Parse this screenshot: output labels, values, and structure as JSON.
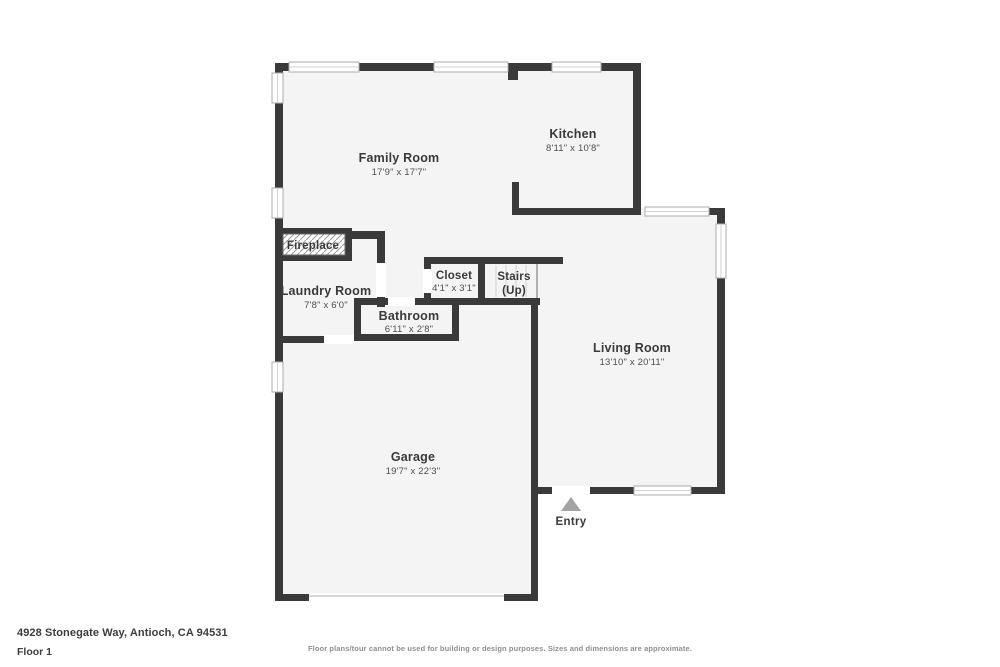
{
  "plan": {
    "wall_color": "#3a3a3a",
    "floor_color": "#f4f4f4",
    "rooms": {
      "family": {
        "name": "Family Room",
        "dims": "17'9\" x 17'7\""
      },
      "kitchen": {
        "name": "Kitchen",
        "dims": "8'11\" x 10'8\""
      },
      "fireplace": {
        "name": "Fireplace"
      },
      "laundry": {
        "name": "Laundry Room",
        "dims": "7'8\" x 6'0\""
      },
      "closet": {
        "name": "Closet",
        "dims": "4'1\" x 3'1\""
      },
      "stairs": {
        "name": "Stairs",
        "sub": "(Up)"
      },
      "bathroom": {
        "name": "Bathroom",
        "dims": "6'11\" x 2'8\""
      },
      "living": {
        "name": "Living Room",
        "dims": "13'10\" x 20'11\""
      },
      "garage": {
        "name": "Garage",
        "dims": "19'7\" x 22'3\""
      }
    },
    "entry": {
      "label": "Entry"
    }
  },
  "footer": {
    "address": "4928 Stonegate Way, Antioch, CA 94531",
    "floor": "Floor 1",
    "disclaimer": "Floor plans/tour cannot be used for building or design purposes. Sizes and dimensions are approximate."
  }
}
